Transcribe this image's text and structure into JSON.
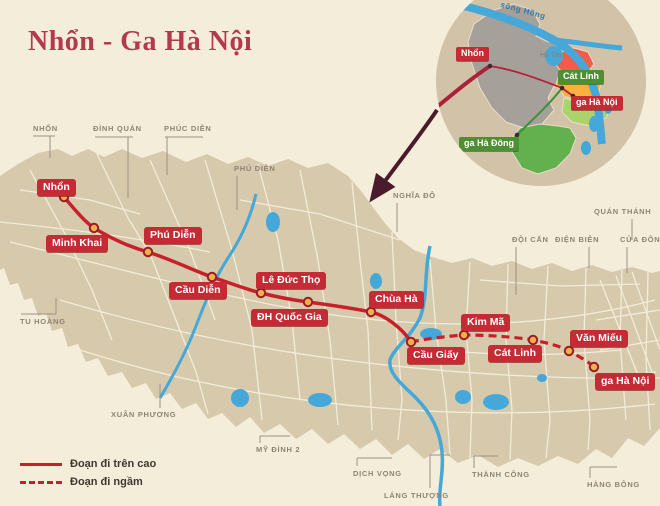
{
  "title": "Nhổn - Ga Hà Nội",
  "stations": [
    {
      "name": "Nhổn",
      "section": "elevated"
    },
    {
      "name": "Minh Khai",
      "section": "elevated"
    },
    {
      "name": "Phú Diễn",
      "section": "elevated"
    },
    {
      "name": "Cầu Diễn",
      "section": "elevated"
    },
    {
      "name": "Lê Đức Thọ",
      "section": "elevated"
    },
    {
      "name": "ĐH Quốc Gia",
      "section": "elevated"
    },
    {
      "name": "Chùa Hà",
      "section": "elevated"
    },
    {
      "name": "Cầu Giấy",
      "section": "elevated"
    },
    {
      "name": "Kim Mã",
      "section": "underground"
    },
    {
      "name": "Cát Linh",
      "section": "underground"
    },
    {
      "name": "Văn Miếu",
      "section": "underground"
    },
    {
      "name": "ga Hà Nội",
      "section": "underground"
    }
  ],
  "top_area_labels": [
    {
      "text": "NHỔN"
    },
    {
      "text": "ĐÌNH QUÁN"
    },
    {
      "text": "PHÚC DIỄN"
    }
  ],
  "area_labels": [
    {
      "text": "PHÚ DIỄN"
    },
    {
      "text": "NGHĨA ĐÔ"
    },
    {
      "text": "QUÁN THÁNH"
    },
    {
      "text": "ĐỘI CẤN"
    },
    {
      "text": "ĐIỆN BIÊN"
    },
    {
      "text": "CỬA ĐÔNG"
    },
    {
      "text": "TU HOÀNG"
    },
    {
      "text": "XUÂN PHƯƠNG"
    },
    {
      "text": "MỸ ĐÌNH 2"
    },
    {
      "text": "DỊCH VỌNG"
    },
    {
      "text": "LÁNG THƯỢNG"
    },
    {
      "text": "THÀNH CÔNG"
    },
    {
      "text": "HÀNG BÔNG"
    }
  ],
  "legend": {
    "items": [
      {
        "label": "Đoạn đi trên cao",
        "style": "solid"
      },
      {
        "label": "Đoạn đi ngầm",
        "style": "dashed"
      }
    ]
  },
  "inset": {
    "nhon": "Nhổn",
    "cat_linh": "Cát Linh",
    "ga_ha_noi": "ga Hà Nội",
    "ga_ha_dong": "ga Hà Đông",
    "river": "sông Hồng",
    "lake": "Hồ Tây"
  },
  "colors": {
    "line_red": "#c8202b",
    "label_red": "#c42b35",
    "label_green": "#4f8f33",
    "land": "#d7c9ac",
    "background": "#f4edda",
    "water": "#45a8d8",
    "arrow": "#4a1c2b",
    "station_fill": "#f2b04b",
    "title_red": "#b23a4c"
  }
}
